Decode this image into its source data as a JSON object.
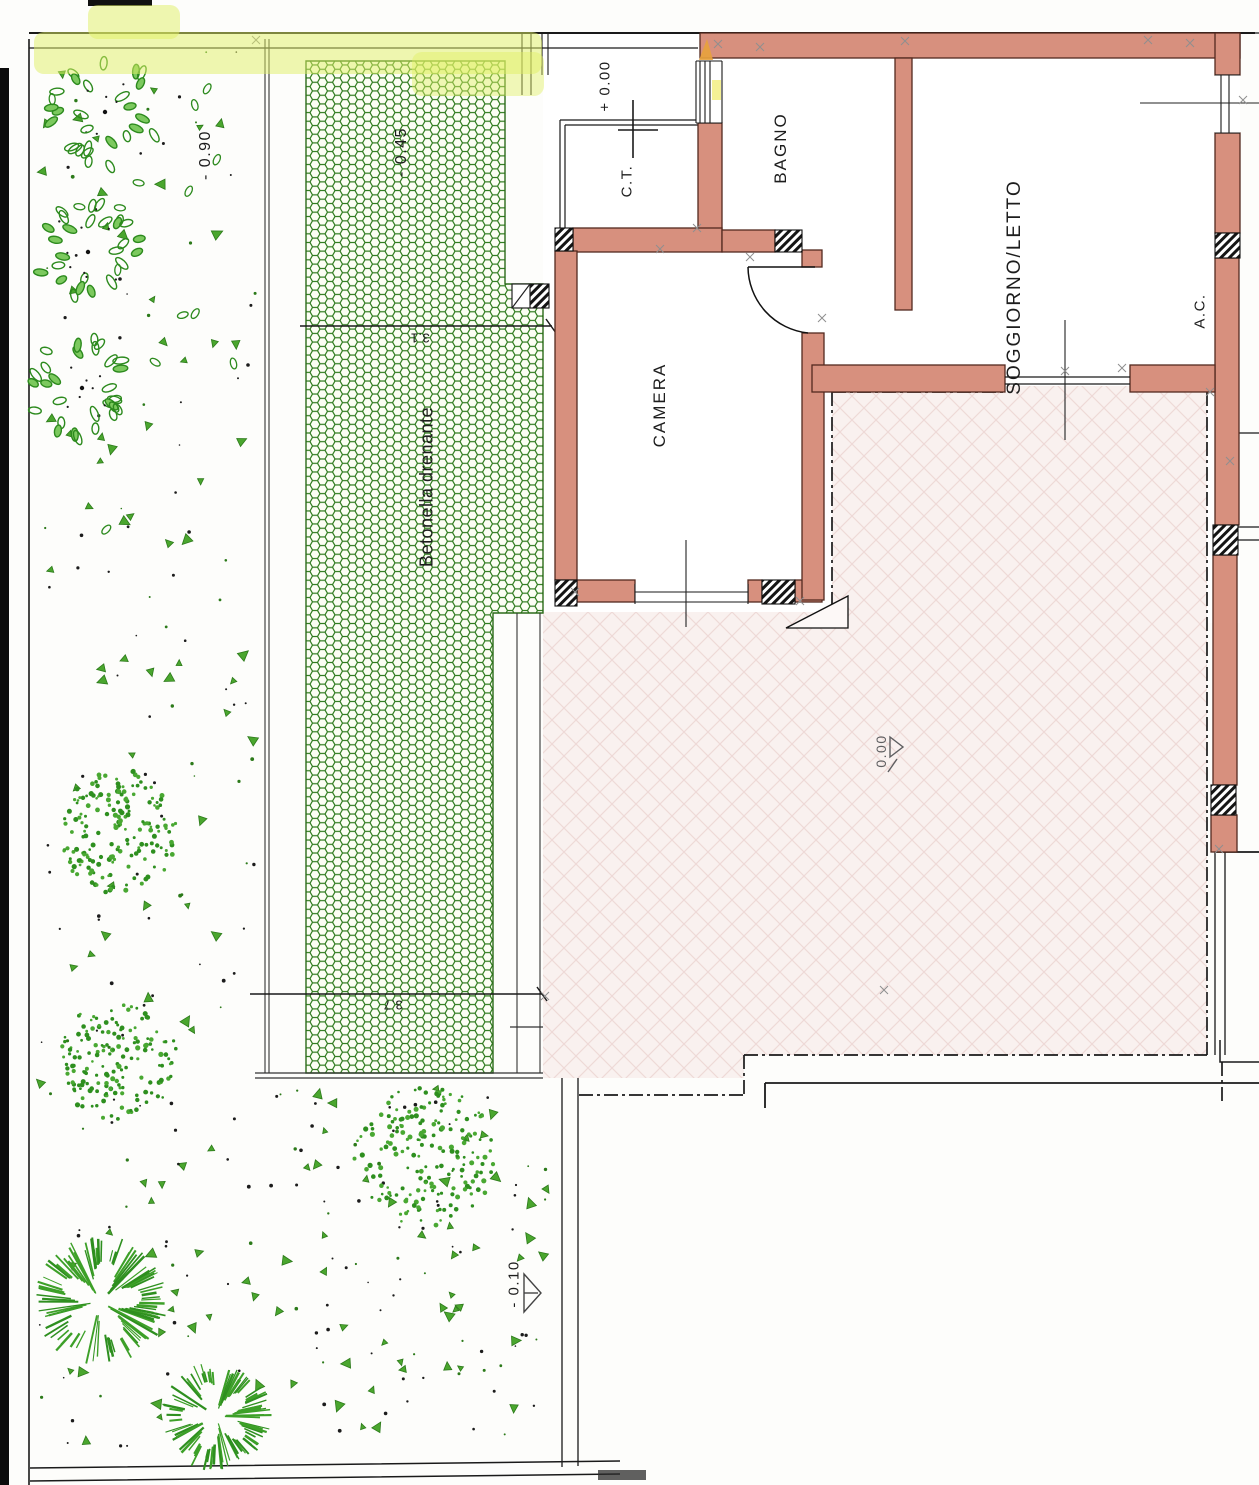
{
  "plan": {
    "type": "architectural-site-plan",
    "rooms": {
      "ct": {
        "label": "C.T."
      },
      "bagno": {
        "label": "BAGNO"
      },
      "soggiorno": {
        "label": "SOGGIORNO/LETTO"
      },
      "camera": {
        "label": "CAMERA"
      },
      "ac": {
        "label": "A.C."
      }
    },
    "annotations": {
      "paving": "Betonella drenante"
    },
    "levels": {
      "entrance": "+ 0.00",
      "patio": "0.00",
      "paving_strip": "- 0.45",
      "garden_north": "- 0.90",
      "garden_south": "- 0.10"
    },
    "dimensions": {
      "paving_width_north": "3.1",
      "paving_width_south": "3.7"
    },
    "colors": {
      "wall_masonry": "#d7907e",
      "paving_hex_green": "#2e7a1d",
      "garden_green": "#2f8f1f",
      "marker_highlight": "#dff063",
      "patio_fill": "#f9f1ef"
    }
  }
}
